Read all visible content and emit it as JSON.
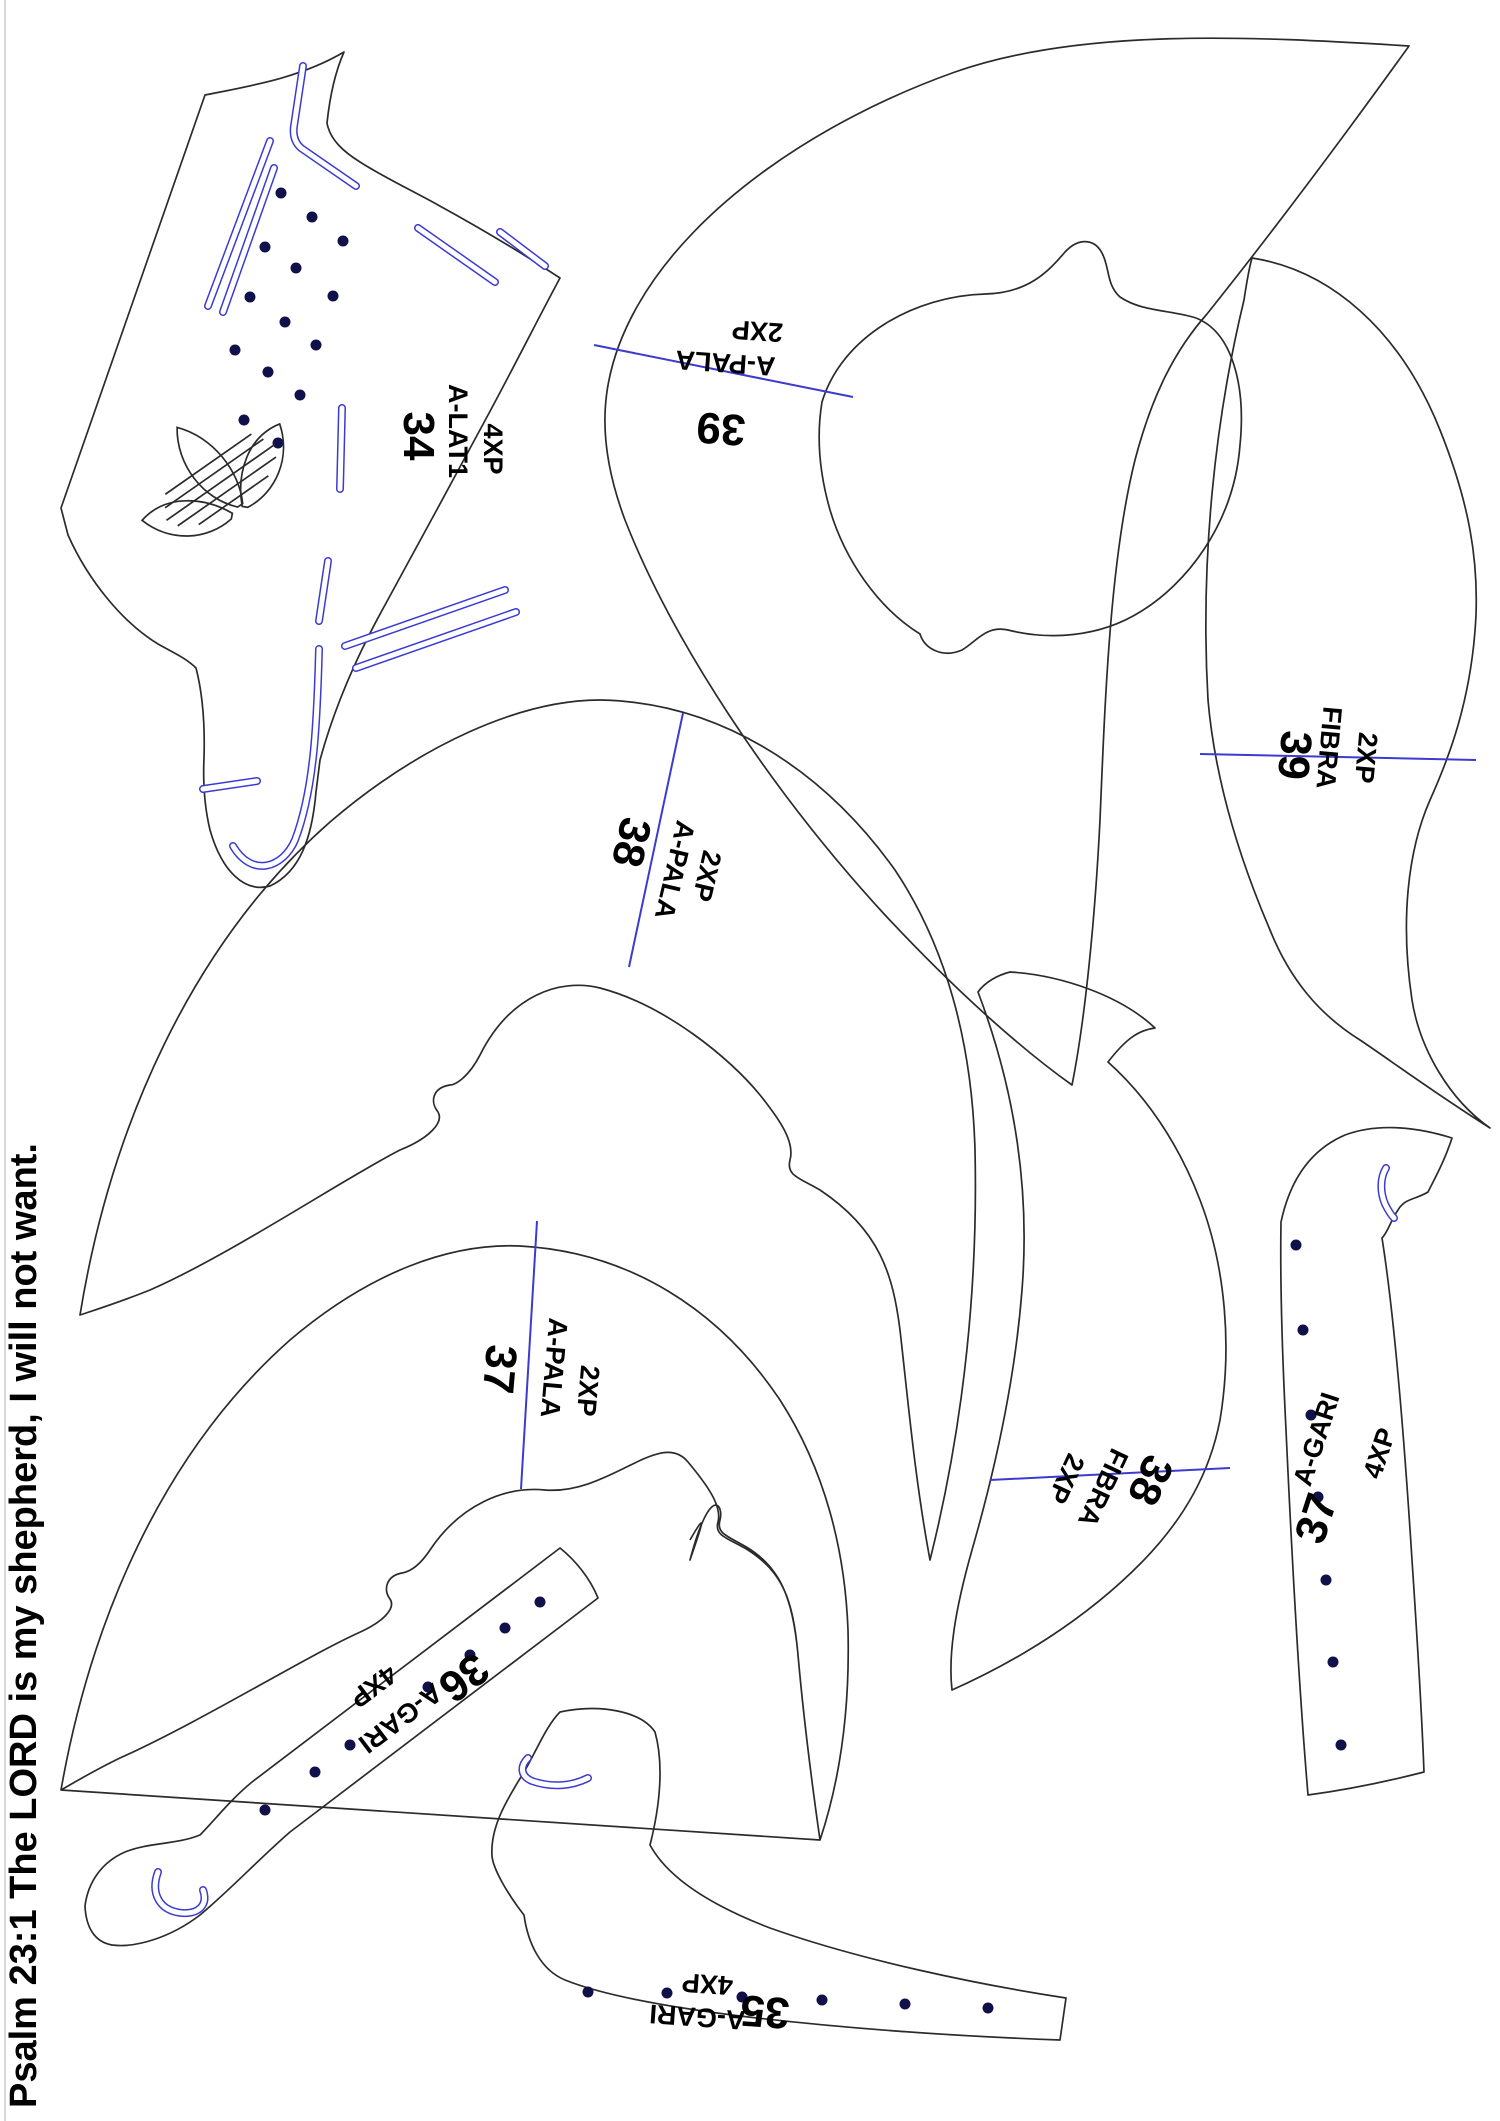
{
  "page": {
    "margin_note": "Psalm 23:1 The LORD is my shepherd, I will not want."
  },
  "pieces": [
    {
      "number": "34",
      "name": "A-LAT1",
      "quantity": "4XP"
    },
    {
      "number": "39",
      "name": "A-PALA",
      "quantity": "2XP"
    },
    {
      "number": "39",
      "name": "FIBRA",
      "quantity": "2XP"
    },
    {
      "number": "38",
      "name": "A-PALA",
      "quantity": "2XP"
    },
    {
      "number": "37",
      "name": "A-PALA",
      "quantity": "2XP"
    },
    {
      "number": "38",
      "name": "FIBRA",
      "quantity": "2XP"
    },
    {
      "number": "37",
      "name": "A-GARI",
      "quantity": "4XP"
    },
    {
      "number": "36",
      "name": "A-GARI",
      "quantity": "4XP"
    },
    {
      "number": "35",
      "name": "A-GARI",
      "quantity": "4XP"
    }
  ],
  "colors": {
    "outline": "#2b2b2b",
    "marking": "#3b3bd1",
    "dot": "#10104a",
    "background": "#ffffff"
  }
}
